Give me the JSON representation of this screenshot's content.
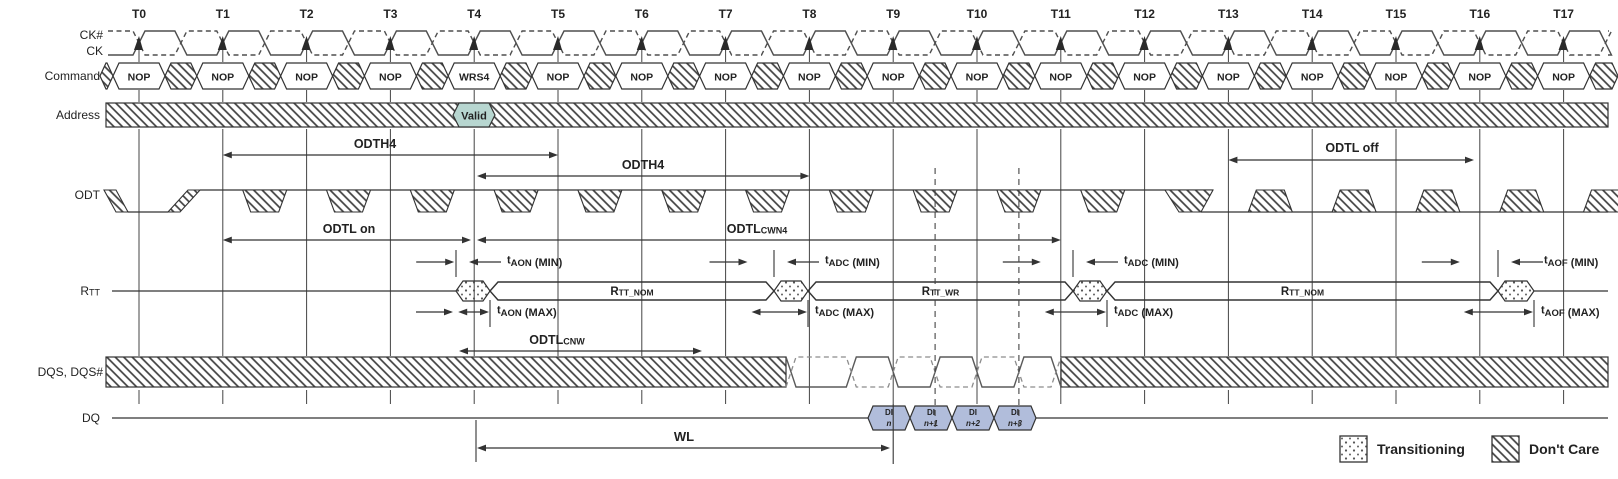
{
  "ticks": [
    "T0",
    "T1",
    "T2",
    "T3",
    "T4",
    "T5",
    "T6",
    "T7",
    "T8",
    "T9",
    "T10",
    "T11",
    "T12",
    "T13",
    "T14",
    "T15",
    "T16",
    "T17"
  ],
  "row_labels": {
    "ck_n": "CK#",
    "ck": "CK",
    "command": "Command",
    "address": "Address",
    "odt": "ODT",
    "rtt": [
      "R",
      "TT"
    ],
    "dqs": "DQS, DQS#",
    "dq": "DQ"
  },
  "commands": [
    "NOP",
    "NOP",
    "NOP",
    "NOP",
    "WRS4",
    "NOP",
    "NOP",
    "NOP",
    "NOP",
    "NOP",
    "NOP",
    "NOP",
    "NOP",
    "NOP",
    "NOP",
    "NOP",
    "NOP",
    "NOP"
  ],
  "address_valid": "Valid",
  "timing": {
    "odth4_left": "ODTH4",
    "odth4_mid": "ODTH4",
    "odtl_on": "ODTL on",
    "odtl_cwn4": [
      "ODTL",
      "CWN4"
    ],
    "odtl_cnw": [
      "ODTL",
      "CNW"
    ],
    "odtl_off": "ODTL off",
    "taon_min": [
      "t",
      "AON",
      " (MIN)"
    ],
    "taon_max": [
      "t",
      "AON",
      " (MAX)"
    ],
    "tadc_min": [
      "t",
      "ADC",
      " (MIN)"
    ],
    "tadc_max": [
      "t",
      "ADC",
      " (MAX)"
    ],
    "taof_min": [
      "t",
      "AOF",
      " (MIN)"
    ],
    "taof_max": [
      "t",
      "AOF",
      " (MAX)"
    ],
    "wl": "WL"
  },
  "rtt_segments": [
    [
      "R",
      "TT_NOM"
    ],
    [
      "R",
      "TT_WR"
    ],
    [
      "R",
      "TT_NOM"
    ]
  ],
  "dq_cells": [
    [
      "DI",
      "n"
    ],
    [
      "DI",
      "n+1"
    ],
    [
      "DI",
      "n+2"
    ],
    [
      "DI",
      "n+3"
    ]
  ],
  "legend": {
    "transitioning": "Transitioning",
    "dont_care": "Don't Care"
  },
  "colors": {
    "ink": "#333333",
    "clock": "#4f4f4f",
    "valid_fill": "#b7d6d0",
    "dq_fill": "#b1bddb",
    "hatch_line": "#3f3f3f",
    "dot": "#555555"
  }
}
